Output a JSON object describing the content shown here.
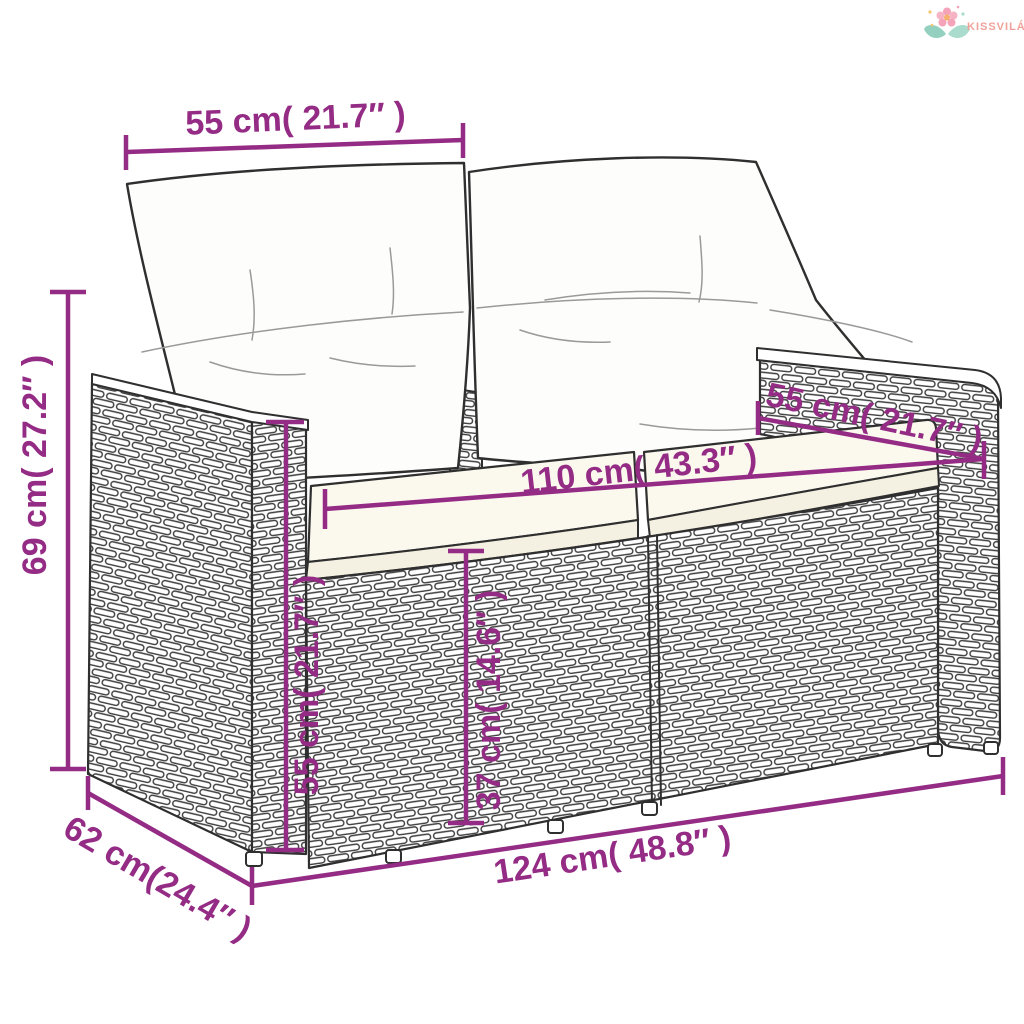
{
  "brand": {
    "name": "KISSVILÁG"
  },
  "colors": {
    "dimension_accent": "#942b84",
    "line_art": "#2f2f2f",
    "logo_text": "#f0a29a",
    "logo_flower": "#f4a3b8",
    "logo_leaf": "#93d0bf"
  },
  "dims": {
    "back_cushion_width": {
      "label": "55 cm( 21.7″ )",
      "cm": 55,
      "inch": 21.7
    },
    "total_height": {
      "label": "69 cm( 27.2″ )",
      "cm": 69,
      "inch": 27.2
    },
    "seat_width": {
      "label": "110 cm( 43.3″ )",
      "cm": 110,
      "inch": 43.3
    },
    "seat_depth": {
      "label": "55 cm( 21.7″ )",
      "cm": 55,
      "inch": 21.7
    },
    "armrest_height": {
      "label": "55 cm( 21.7″ )",
      "cm": 55,
      "inch": 21.7
    },
    "seat_height": {
      "label": "37 cm( 14.6″ )",
      "cm": 37,
      "inch": 14.6
    },
    "depth": {
      "label": "62 cm(24.4″ )",
      "cm": 62,
      "inch": 24.4
    },
    "total_width": {
      "label": "124 cm( 48.8″ )",
      "cm": 124,
      "inch": 48.8
    }
  }
}
